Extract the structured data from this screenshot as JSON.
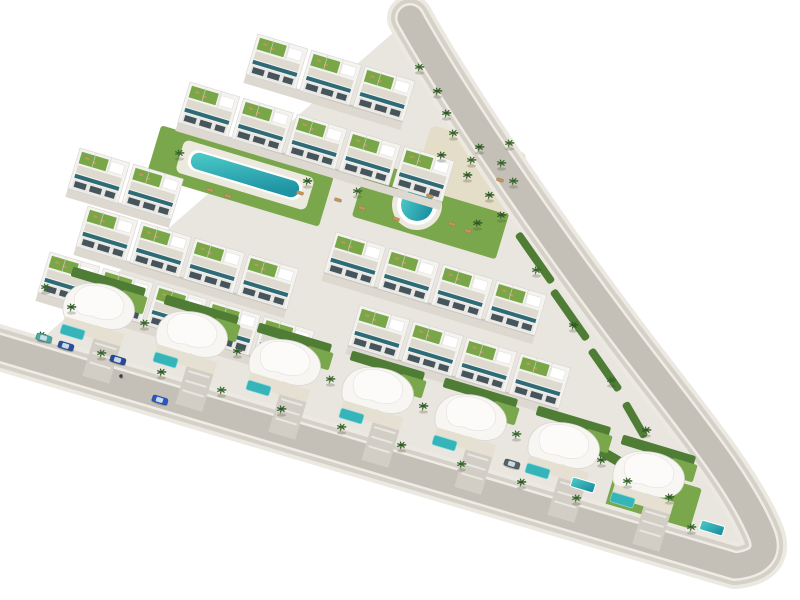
{
  "scene": {
    "width": 800,
    "height": 600,
    "angle_deg": 16.7,
    "background": "#ffffff",
    "description": "Aerial 3D architectural render of a triangular residential development: terraced white apartment rows with green roof gardens, sculptural white villas with private pools, two communal pools, palm trees, and a perimeter road with a car"
  },
  "palette": {
    "ground": "#e9e6df",
    "road_outer": "#ece9e2",
    "road_mid": "#d5d1c8",
    "road_curb": "#efece5",
    "road_asphalt": "#c4c0b7",
    "lawn": "#7aa74b",
    "lawn_dark": "#5d8a3a",
    "hedge": "#4f7d35",
    "sand": "#e4ddc8",
    "building": "#f4f3f0",
    "building_stroke": "#d6d4cf",
    "roof_garden": "#79a748",
    "terrace": "#dedacf",
    "balcony_glass": "#2f6b76",
    "facade": "#e9e7e3",
    "window": "#46555c",
    "deck": "#eceadf",
    "pool_light": "#4ecdc9",
    "pool_deep": "#1f93a4",
    "pool_flat": "#35b4ba",
    "pool_rim": "#8edcda",
    "driveway": "#d2cec5",
    "walkway": "#ddd9d0",
    "palm_leaf": "#36652b",
    "palm_leaf_alt": "#2e5a26",
    "palm_trunk": "#9b8a68",
    "lounger": "#c2955e",
    "lounger_stroke": "#9a7446",
    "shadow": "rgba(90,90,80,0.25)",
    "person": "#3a3f44"
  },
  "plot": {
    "apex": [
      410,
      18
    ],
    "right_curve": [
      [
        450,
        90
      ],
      [
        530,
        210
      ],
      [
        620,
        330
      ],
      [
        680,
        410
      ],
      [
        740,
        480
      ],
      [
        762,
        535
      ]
    ],
    "corner_bottom": [
      735,
      566
    ],
    "road_left_end": [
      -20,
      342
    ],
    "ground_left": [
      22,
      356
    ]
  },
  "road": {
    "outer_w": 46,
    "mid_w": 38,
    "curb_w": 30,
    "asphalt_w": 25
  },
  "lawns": [
    {
      "cx": 240,
      "cy": 176,
      "w": 180,
      "h": 52
    },
    {
      "cx": 432,
      "cy": 210,
      "w": 150,
      "h": 58
    },
    {
      "cx": 652,
      "cy": 502,
      "w": 88,
      "h": 54
    }
  ],
  "sand_patches": [
    {
      "cx": 470,
      "cy": 170,
      "w": 100,
      "h": 64
    }
  ],
  "communal_pools": {
    "lap": {
      "cx": 245,
      "cy": 175,
      "deck_w": 136,
      "deck_h": 34,
      "w": 112,
      "h": 17
    },
    "round": {
      "cx": 417,
      "cy": 205,
      "deck_r": 25,
      "rim_r": 20,
      "r": 16
    }
  },
  "apartment_rows": [
    {
      "x": 258,
      "y": 34,
      "units": 3
    },
    {
      "x": 190,
      "y": 82,
      "units": 5
    },
    {
      "x": 80,
      "y": 148,
      "units": 2
    },
    {
      "x": 88,
      "y": 206,
      "units": 4
    },
    {
      "x": 336,
      "y": 232,
      "units": 4
    },
    {
      "x": 50,
      "y": 252,
      "units": 5
    },
    {
      "x": 360,
      "y": 305,
      "units": 4
    }
  ],
  "apartment_unit": {
    "w": 56,
    "block_w": 52,
    "block_h": 42
  },
  "villas": [
    [
      100,
      310
    ],
    [
      193,
      338
    ],
    [
      286,
      366
    ],
    [
      379,
      394
    ],
    [
      472,
      421
    ],
    [
      565,
      449
    ],
    [
      650,
      478
    ]
  ],
  "extra_pools": [
    [
      583,
      485
    ],
    [
      712,
      528
    ]
  ],
  "hedges": [
    {
      "x": 535,
      "y": 258,
      "w": 60,
      "h": 8,
      "rot": 55
    },
    {
      "x": 570,
      "y": 315,
      "w": 60,
      "h": 8,
      "rot": 55
    },
    {
      "x": 605,
      "y": 370,
      "w": 50,
      "h": 8,
      "rot": 55
    },
    {
      "x": 635,
      "y": 420,
      "w": 40,
      "h": 8,
      "rot": 60
    },
    {
      "x": 625,
      "y": 465,
      "w": 66,
      "h": 10,
      "rot": 30
    }
  ],
  "palms": [
    [
      40,
      340
    ],
    [
      100,
      358
    ],
    [
      160,
      377
    ],
    [
      220,
      395
    ],
    [
      280,
      414
    ],
    [
      340,
      432
    ],
    [
      400,
      450
    ],
    [
      460,
      469
    ],
    [
      520,
      487
    ],
    [
      575,
      503
    ],
    [
      445,
      118
    ],
    [
      470,
      165
    ],
    [
      500,
      220
    ],
    [
      535,
      275
    ],
    [
      572,
      330
    ],
    [
      610,
      385
    ],
    [
      645,
      435
    ],
    [
      452,
      138
    ],
    [
      478,
      152
    ],
    [
      500,
      168
    ],
    [
      466,
      180
    ],
    [
      512,
      186
    ],
    [
      488,
      200
    ],
    [
      508,
      148
    ],
    [
      440,
      160
    ],
    [
      418,
      72
    ],
    [
      436,
      96
    ],
    [
      178,
      158
    ],
    [
      306,
      186
    ],
    [
      356,
      196
    ],
    [
      476,
      228
    ],
    [
      143,
      328
    ],
    [
      236,
      356
    ],
    [
      329,
      384
    ],
    [
      422,
      411
    ],
    [
      515,
      439
    ],
    [
      600,
      465
    ],
    [
      44,
      292
    ],
    [
      70,
      312
    ],
    [
      626,
      486
    ],
    [
      668,
      502
    ],
    [
      690,
      532
    ]
  ],
  "loungers": [
    [
      210,
      190
    ],
    [
      228,
      196
    ],
    [
      300,
      193
    ],
    [
      338,
      200
    ],
    [
      362,
      208
    ],
    [
      396,
      219
    ],
    [
      430,
      196
    ],
    [
      452,
      224
    ],
    [
      468,
      231
    ],
    [
      500,
      180
    ]
  ],
  "cars": {
    "moving": [
      {
        "x": 160,
        "y": 400,
        "color": "#2a55c8"
      }
    ],
    "parked": [
      {
        "x": 44,
        "y": 338,
        "color": "#49a8a2"
      },
      {
        "x": 66,
        "y": 346,
        "color": "#2b4fa0"
      },
      {
        "x": 118,
        "y": 360,
        "color": "#27489c"
      },
      {
        "x": 512,
        "y": 464,
        "color": "#595f62"
      }
    ]
  },
  "people": [
    [
      121,
      377
    ]
  ]
}
